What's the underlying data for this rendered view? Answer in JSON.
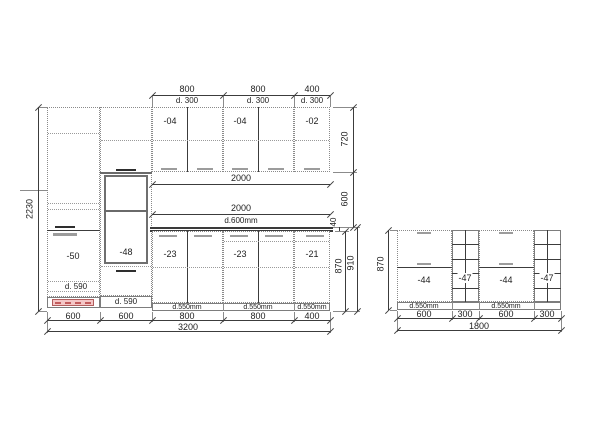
{
  "left_elevation": {
    "top_dims": [
      {
        "len": "800",
        "depth": "d. 300"
      },
      {
        "len": "800",
        "depth": "d. 300"
      },
      {
        "len": "400",
        "depth": "d. 300"
      }
    ],
    "wall_cabinets": [
      {
        "label": "-04"
      },
      {
        "label": "-04"
      },
      {
        "label": "-02"
      }
    ],
    "tall_cabinets": [
      {
        "label": "-50",
        "plinth_label": "d. 590"
      },
      {
        "label": "-48",
        "plinth_label": "d. 590"
      }
    ],
    "base_cabinets": [
      {
        "label": "-23",
        "depth_label": "d.550mm"
      },
      {
        "label": "-23",
        "depth_label": "d.550mm"
      },
      {
        "label": "-21",
        "depth_label": "d.550mm"
      }
    ],
    "span_dims": {
      "upper": "2000",
      "lower": "2000",
      "lower_depth": "d.600mm"
    },
    "height_dim": "2230",
    "right_dims": {
      "wall_height": "720",
      "gap": "600",
      "countertop": "40",
      "base_height": "870",
      "base_total": "910"
    },
    "bottom_dims": [
      "600",
      "600",
      "800",
      "800",
      "400"
    ],
    "total_width": "3200"
  },
  "island_elevation": {
    "units": [
      {
        "label": "-44",
        "depth_label": "d.550mm"
      },
      {
        "label": "-47"
      },
      {
        "label": "-44",
        "depth_label": "d.550mm"
      },
      {
        "label": "-47"
      }
    ],
    "height_dim": "870",
    "bottom_dims": [
      "600",
      "300",
      "600",
      "300"
    ],
    "total_width": "1800"
  },
  "colors": {
    "line": "#3c3c3c",
    "outline_dotted": "#8a8a8a",
    "handle_dark": "#2e2e2e",
    "handle_gray": "#9c9c9c",
    "heater_fill": "#f4c6c6",
    "heater_stroke": "#b15d5d"
  }
}
